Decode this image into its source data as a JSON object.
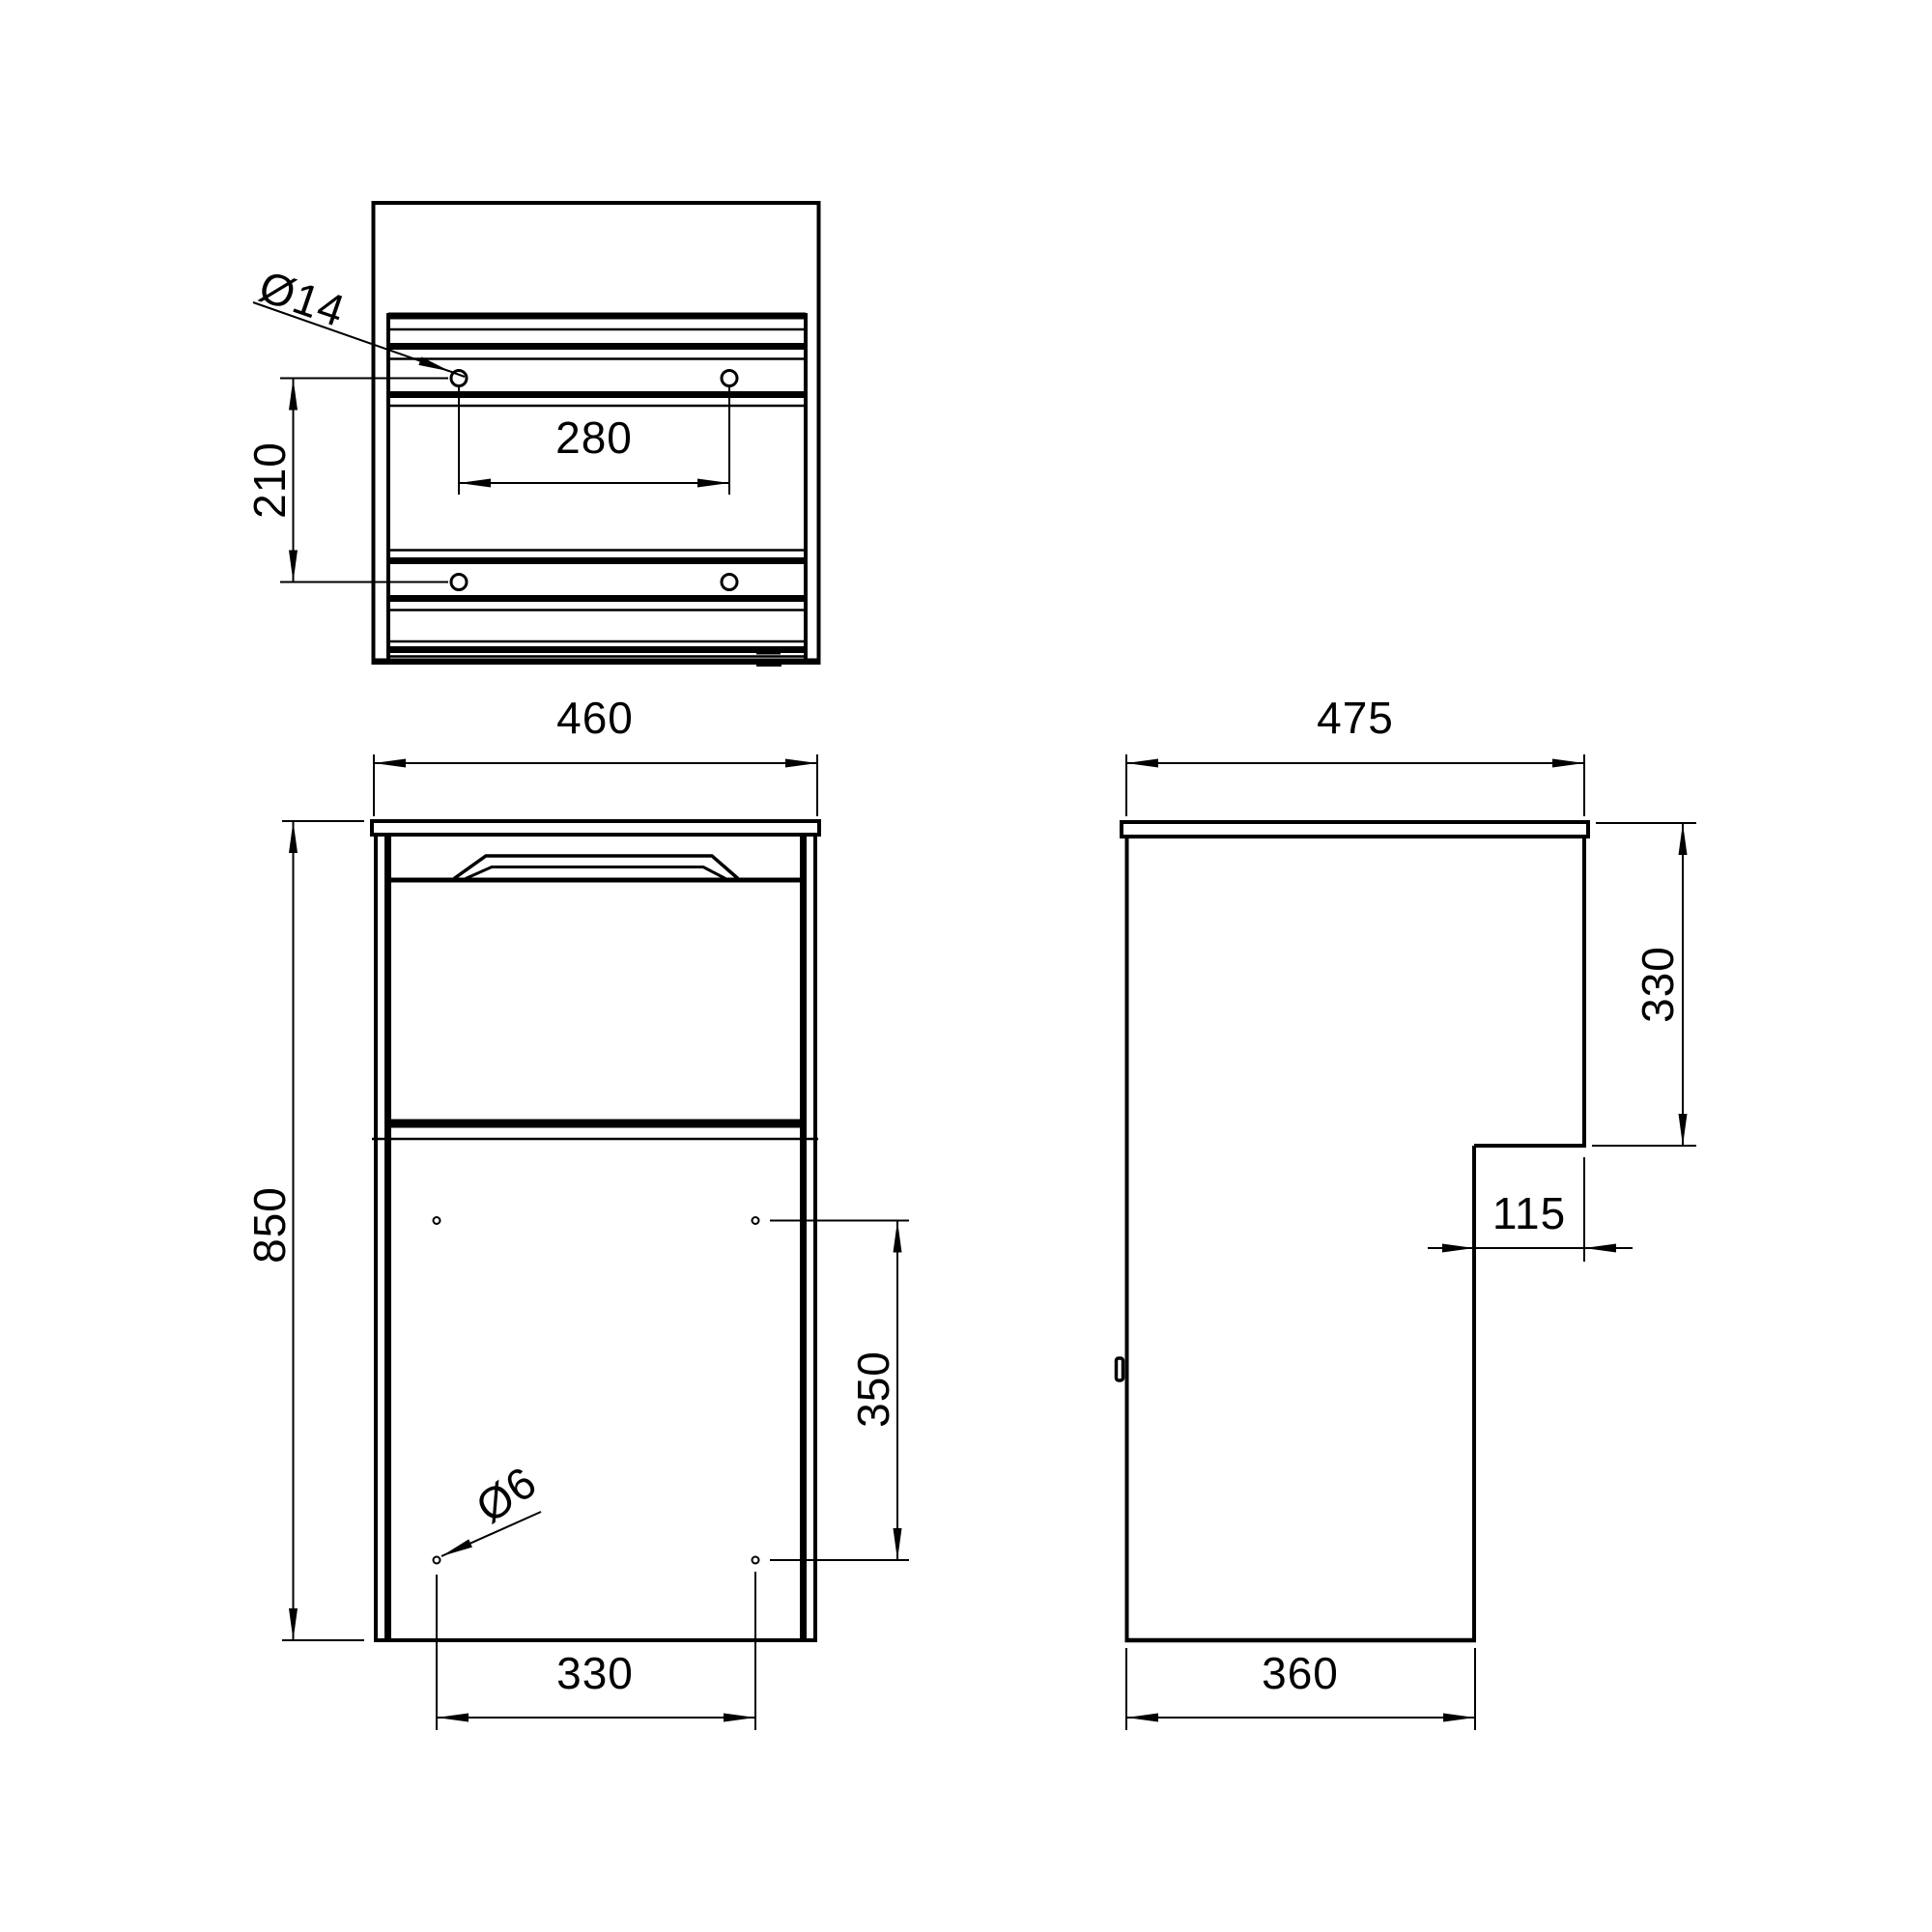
{
  "colors": {
    "background": "#ffffff",
    "line": "#000000"
  },
  "views": {
    "rear": {
      "hole_diameter_label": "Ø14",
      "hole_spacing_vertical": "210",
      "hole_spacing_horizontal": "280"
    },
    "front": {
      "width": "460",
      "height": "850",
      "hole_diameter_label": "Ø6",
      "hole_spacing_vertical": "350",
      "hole_spacing_horizontal": "330"
    },
    "side": {
      "depth_top": "475",
      "upper_section_height": "330",
      "step_depth": "115",
      "depth_bottom": "360"
    }
  }
}
